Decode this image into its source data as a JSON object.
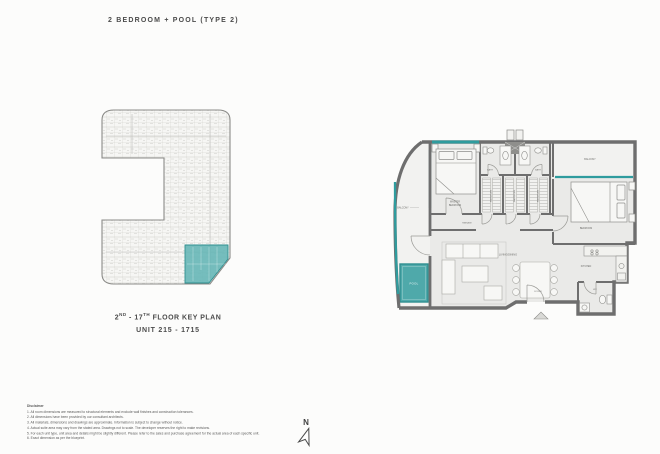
{
  "title": "2 BEDROOM + POOL (TYPE 2)",
  "key_plan": {
    "caption": {
      "floor_prefix": "2",
      "floor_sup1": "ND",
      "floor_mid": " - 17",
      "floor_sup2": "TH",
      "floor_suffix": " FLOOR KEY PLAN",
      "units": "UNIT 215 - 1715"
    }
  },
  "unit_plan": {
    "rooms": {
      "balcony_left": "BALCONY",
      "balcony_right": "BALCONY",
      "master_bedroom_line1": "MASTER",
      "master_bedroom_line2": "BEDROOM",
      "bath_left": "BATH",
      "bath_right": "BATH",
      "wardrobe_1": "WARDROBE",
      "wardrobe_2": "WARDROBE",
      "wardrobe_3": "WARDROBE",
      "passage": "PASSAGE",
      "bedroom": "BEDROOM",
      "living_dining": "LIVING/DINING",
      "kitchen": "KITCHEN",
      "wc": "WC",
      "foyer": "FOYER",
      "pool": "POOL"
    }
  },
  "compass": {
    "label": "N"
  },
  "disclaimer": {
    "heading": "Disclaimer",
    "lines": [
      "1. All room dimensions are measured to structural elements and exclude wall finishes and construction tolerances.",
      "2. All dimensions have been provided by our consultant architects.",
      "3. All materials, dimensions and drawings are approximate. Information is subject to change without notice.",
      "4. Actual suite area may vary from the stated area. Drawings not to scale. The developer reserves the right to make revisions.",
      "5. For each unit type, unit area and details might be slightly different. Please refer to the sales and purchase agreement for the actual area of each specific unit.",
      "6. Exact dimension as per the blueprint."
    ]
  },
  "colors": {
    "accent_teal": "#2F9C9E",
    "pool_fill": "#4FA9AA",
    "wall_gray": "#6E6E6E",
    "floor_fill": "#EAEAE8",
    "keyplan_highlight": "#63B5B5"
  }
}
